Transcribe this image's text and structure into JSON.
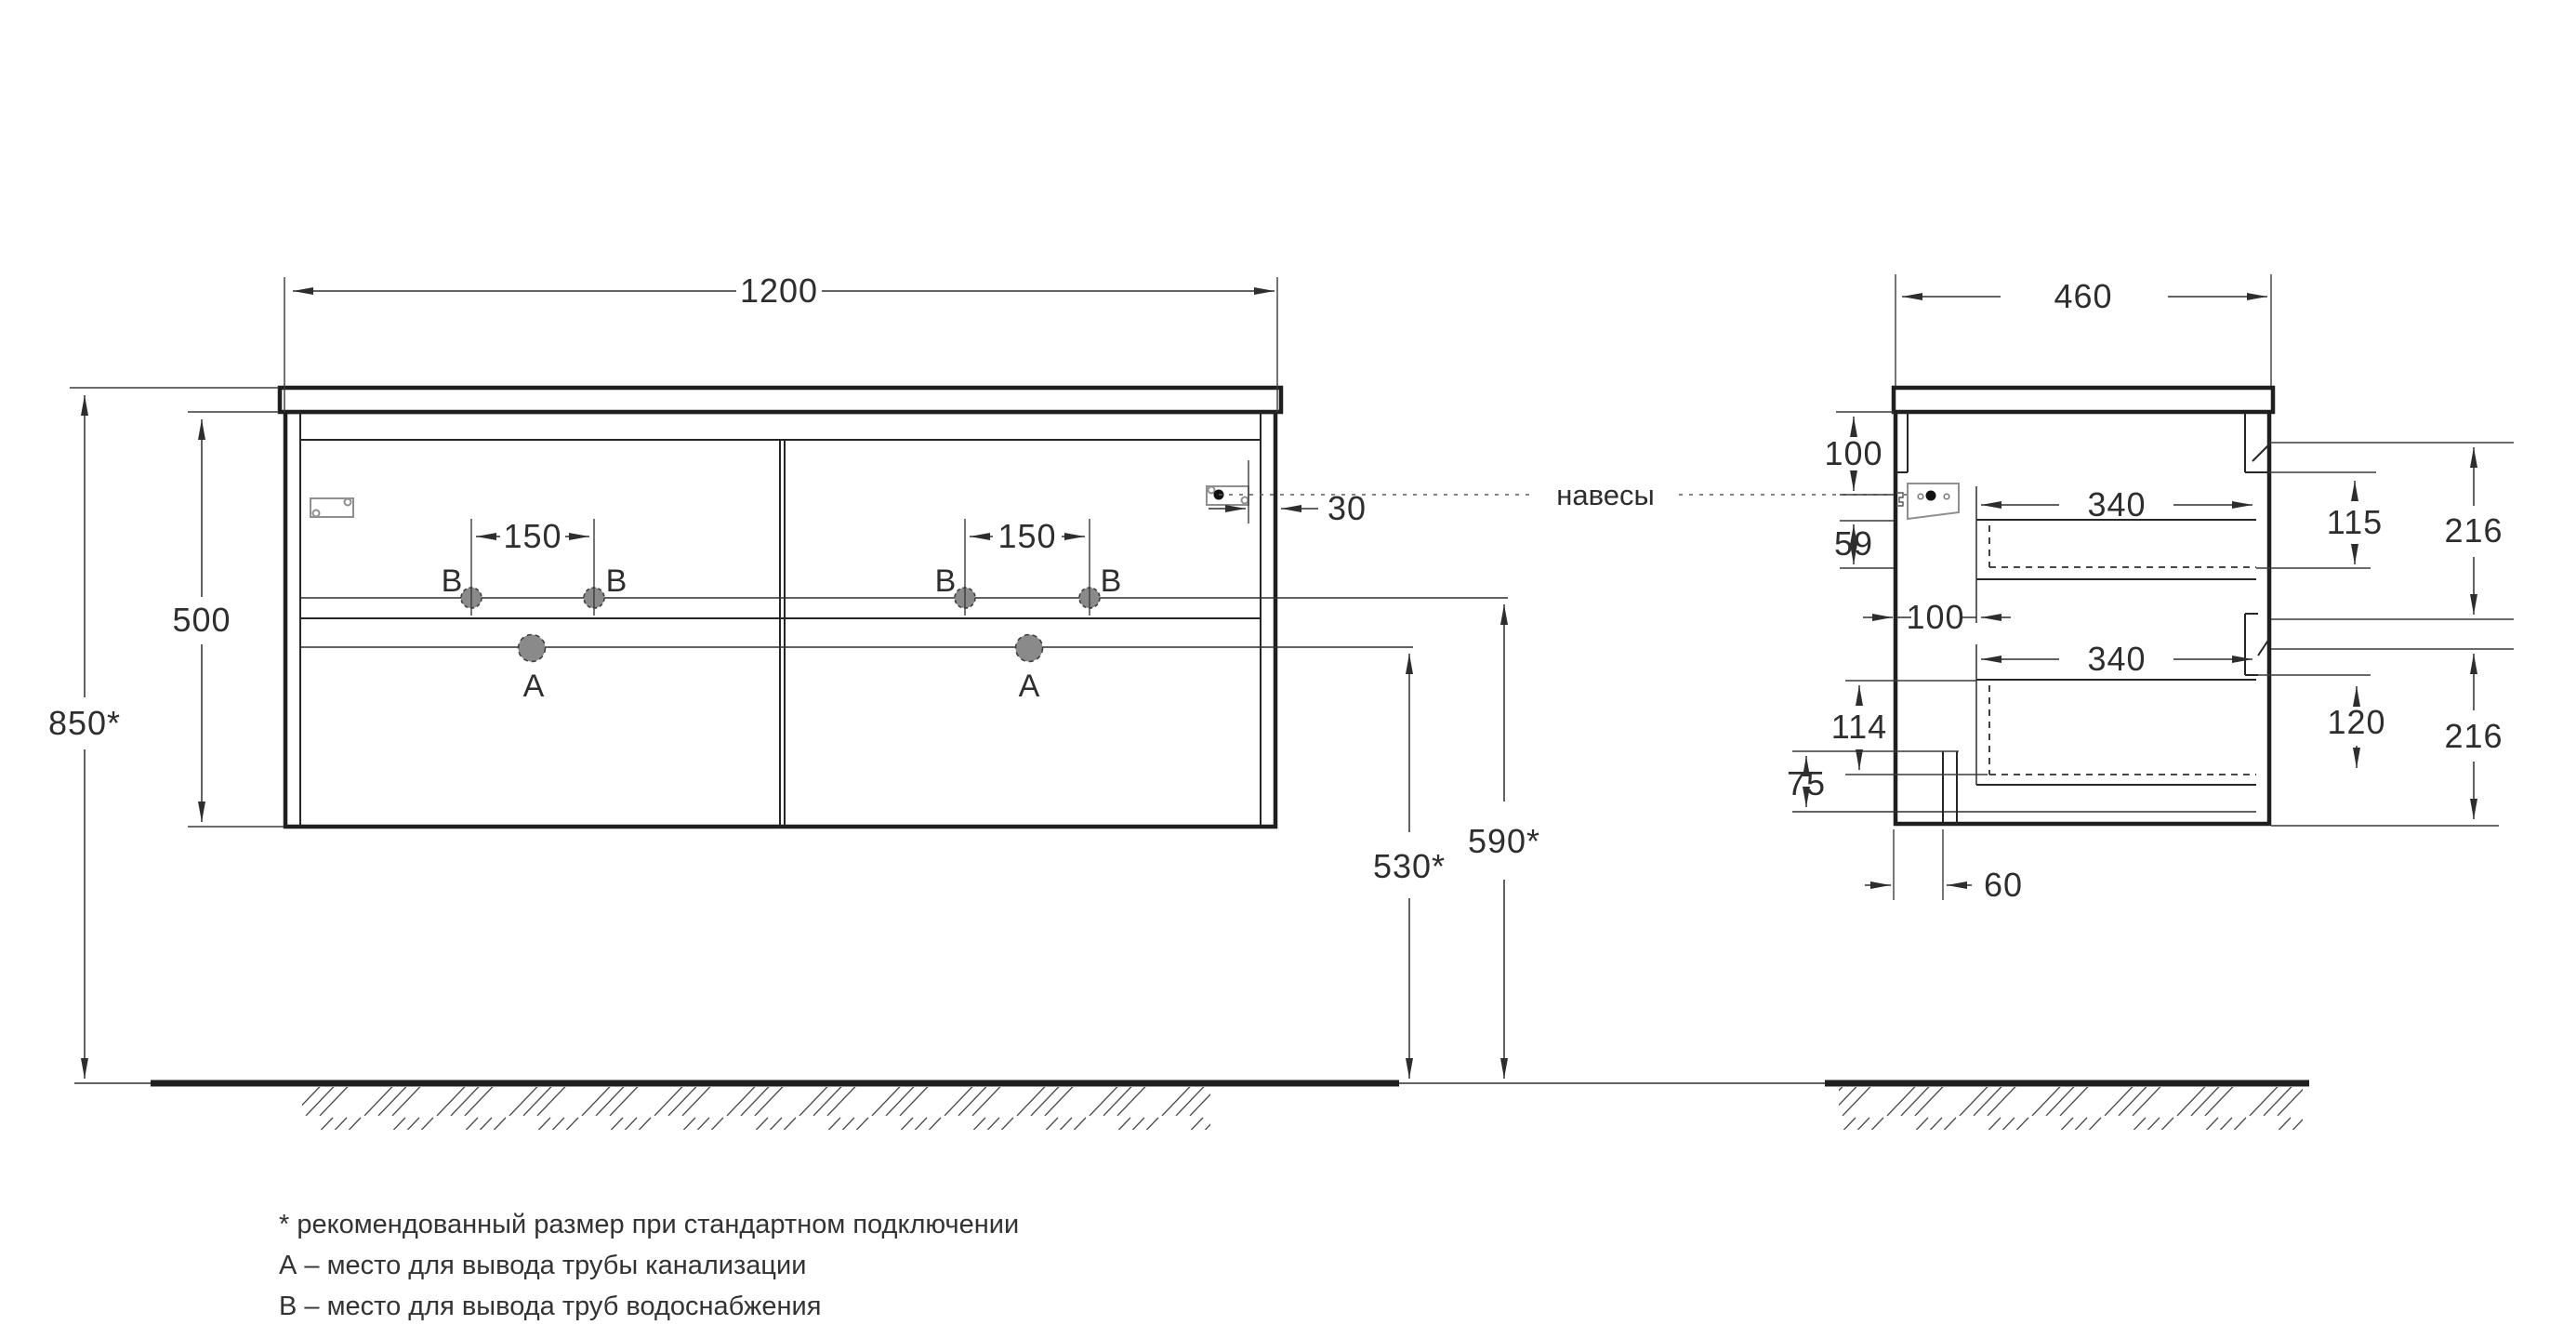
{
  "drawing_title": "vanity cabinet installation drawing",
  "front_view": {
    "dim_width": "1200",
    "dim_height": "500",
    "dim_mount_height": "850*",
    "dim_faucet_left": "150",
    "dim_faucet_right": "150",
    "dim_hinge_offset": "30",
    "dim_drain_height": "530*",
    "dim_water_height": "590*",
    "point_b1": "B",
    "point_b2": "B",
    "point_b3": "B",
    "point_b4": "B",
    "point_a1": "A",
    "point_a2": "A"
  },
  "side_view": {
    "dim_depth": "460",
    "dim_hanger_top": "100",
    "dim_59": "59",
    "dim_back_gap": "100",
    "dim_drawer1_depth": "340",
    "dim_drawer2_depth": "340",
    "dim_115": "115",
    "dim_216_top": "216",
    "dim_114": "114",
    "dim_120": "120",
    "dim_216_bottom": "216",
    "dim_75": "75",
    "dim_60": "60"
  },
  "callout_hangers": "навесы",
  "legend": {
    "line1": "* рекомендованный размер при стандартном подключении",
    "line2": "А – место для вывода трубы канализации",
    "line3": "B – место для вывода труб водоснабжения"
  },
  "colors": {
    "line": "#2e2e2e",
    "hole_fill": "#8a8a8a",
    "background": "#ffffff"
  }
}
